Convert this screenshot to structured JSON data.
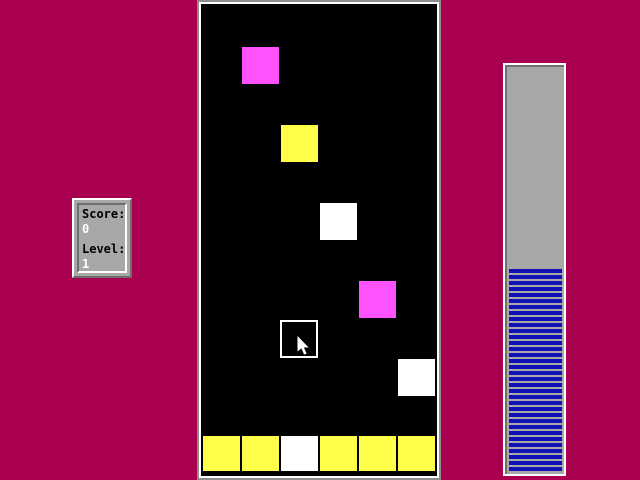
{
  "screen": {
    "background_color": "#aa0050"
  },
  "score_panel": {
    "score_label": "Score:",
    "score_value": "0",
    "level_label": "Level:",
    "level_value": "1"
  },
  "playfield": {
    "block_size": 37,
    "colors": {
      "magenta": "#ff52ff",
      "yellow": "#ffff4a",
      "white": "#ffffff"
    },
    "falling_blocks": [
      {
        "x": 41,
        "y": 43,
        "color": "magenta"
      },
      {
        "x": 80,
        "y": 121,
        "color": "yellow"
      },
      {
        "x": 119,
        "y": 199,
        "color": "white"
      },
      {
        "x": 158,
        "y": 277,
        "color": "magenta"
      },
      {
        "x": 197,
        "y": 355,
        "color": "white"
      }
    ],
    "selector_cell": {
      "x": 79,
      "y": 316,
      "size": 38
    },
    "bottom_row": {
      "y": 432,
      "height": 35,
      "xs": [
        2,
        41,
        80,
        119,
        158,
        197
      ],
      "colors": [
        "yellow",
        "yellow",
        "white",
        "yellow",
        "yellow",
        "yellow"
      ]
    },
    "cursor": {
      "x": 96,
      "y": 332
    }
  },
  "progress_bar": {
    "fill_percent": 50,
    "stripe_color": "#1111b4",
    "gap_color": "#a8a8a8",
    "track_color": "#a8a8a8"
  }
}
